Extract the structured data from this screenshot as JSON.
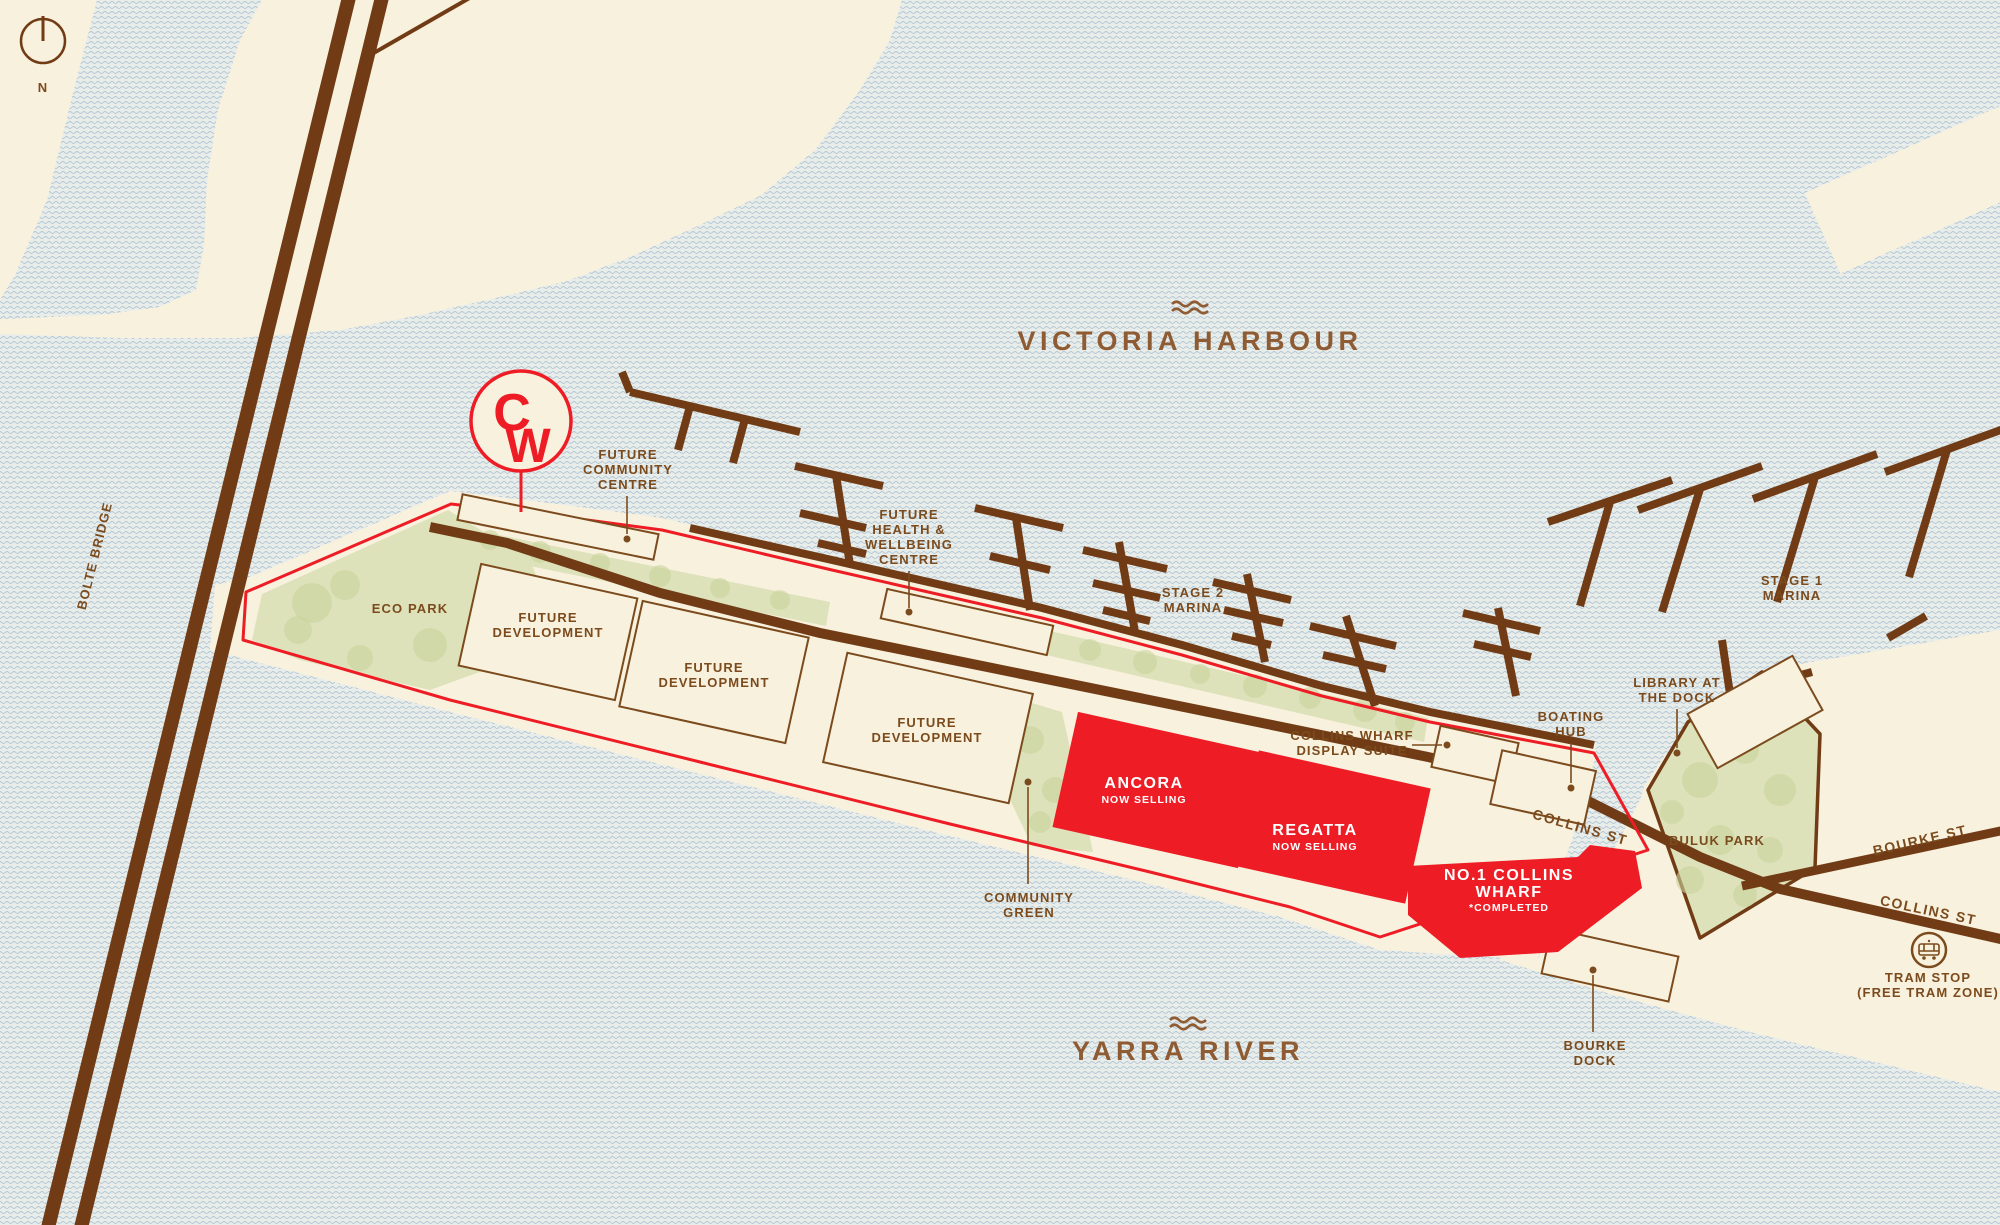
{
  "map_title": "Collins Wharf masterplan map",
  "compass": {
    "north_label": "N"
  },
  "logo": {
    "letter_c": "C",
    "letter_w": "W"
  },
  "water_labels": {
    "victoria_harbour": "VICTORIA HARBOUR",
    "yarra_river": "YARRA RIVER"
  },
  "bridge": {
    "bolte_bridge": "BOLTE BRIDGE"
  },
  "streets": {
    "collins_st_wharf": "COLLINS ST",
    "collins_st_city": "COLLINS ST",
    "bourke_st": "BOURKE ST"
  },
  "parks": {
    "eco_park": "ECO PARK",
    "buluk_park": "BULUK PARK",
    "community_green": [
      "COMMUNITY",
      "GREEN"
    ]
  },
  "marinas": {
    "stage_2": [
      "STAGE 2",
      "MARINA"
    ],
    "stage_1": [
      "STAGE 1",
      "MARINA"
    ]
  },
  "callouts": {
    "future_community_centre": [
      "FUTURE",
      "COMMUNITY",
      "CENTRE"
    ],
    "future_health_wellbeing": [
      "FUTURE",
      "HEALTH &",
      "WELLBEING",
      "CENTRE"
    ],
    "collins_wharf_display_suite": [
      "COLLINS WHARF",
      "DISPLAY SUITE"
    ],
    "boating_hub": [
      "BOATING",
      "HUB"
    ],
    "library_at_the_dock": [
      "LIBRARY AT",
      "THE DOCK"
    ],
    "bourke_dock": [
      "BOURKE",
      "DOCK"
    ],
    "tram_stop": [
      "TRAM STOP",
      "(FREE TRAM ZONE)"
    ]
  },
  "developments": {
    "future_development": [
      "FUTURE",
      "DEVELOPMENT"
    ],
    "ancora": {
      "name": "ANCORA",
      "status": "NOW SELLING"
    },
    "regatta": {
      "name": "REGATTA",
      "status": "NOW SELLING"
    },
    "no1_collins_wharf": {
      "name_line1": "NO.1 COLLINS",
      "name_line2": "WHARF",
      "status": "*COMPLETED"
    }
  },
  "colors": {
    "land_cream": "#f8f1de",
    "water_base": "#e9ede9",
    "water_wave": "#a9c0d3",
    "structure_brown": "#713c15",
    "label_brown": "#7b4b1d",
    "water_label_brown": "#8f5b33",
    "accent_red": "#ee1c25",
    "park_green": "#dee2ba"
  }
}
